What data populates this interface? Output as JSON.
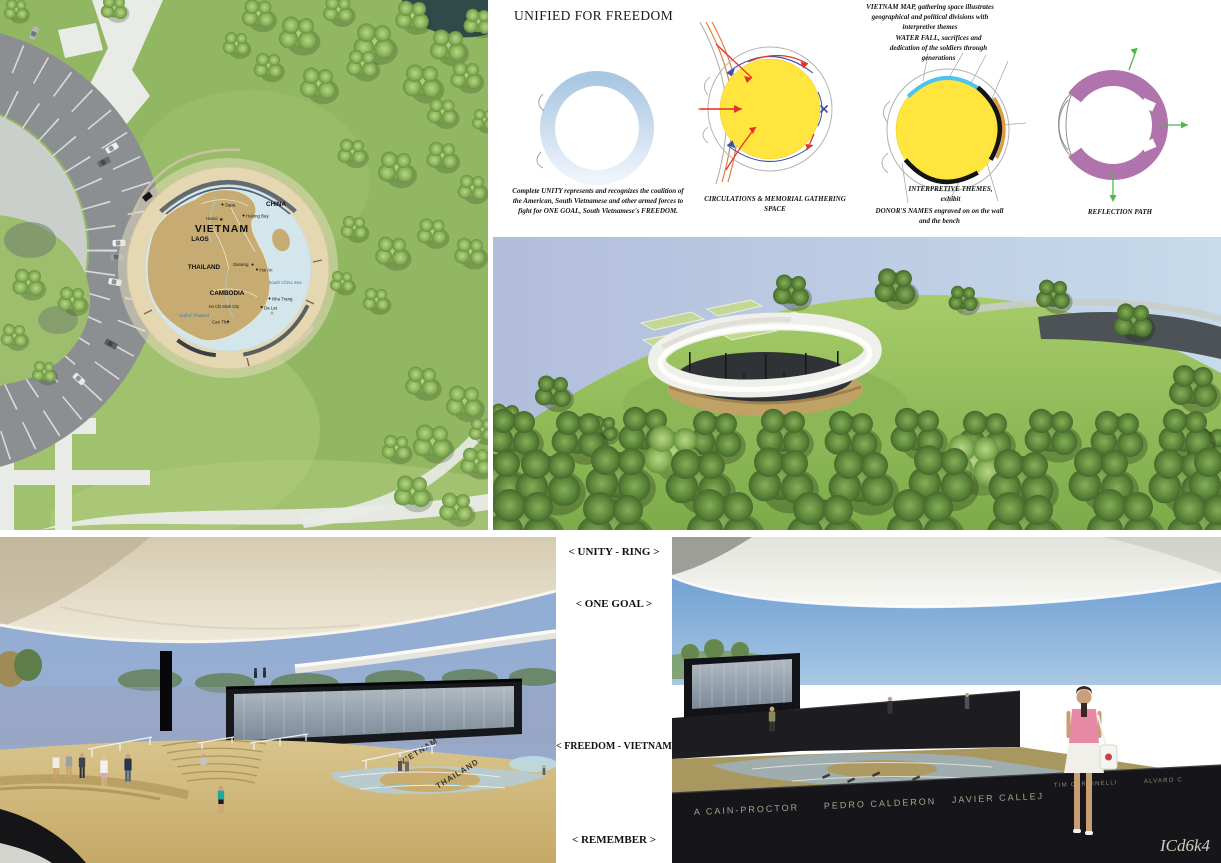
{
  "board": {
    "title": "UNIFIED FOR FREEDOM",
    "watermark": "ICd6k4"
  },
  "site_plan": {
    "labels": {
      "vietnam": "VIETNAM",
      "china": "CHINA",
      "laos": "LAOS",
      "thailand": "THAILAND",
      "cambodia": "CAMBODIA",
      "sapa": "Sapa",
      "hanoi": "Hanoi",
      "halong_bay": "Halong Bay",
      "danang": "Danang",
      "hoi_an": "Hoi An",
      "nha_trang": "Nha Trang",
      "da_lat": "Da Lat",
      "ho_chi_minh_city": "Ho Chi Minh City",
      "can_tho": "Can Tho",
      "south_china_sea": "South China Sea",
      "gulf_of_thailand": "Gulf of Thailand"
    },
    "icons": {
      "hanoi_star": "★"
    }
  },
  "diagrams": {
    "unity": {
      "caption": "Complete UNITY represents and recognizes the coalition of the American, South Vietnamese and other armed forces to fight for ONE GOAL, South Vietnamese's FREEDOM."
    },
    "circulation": {
      "caption": "CIRCULATIONS & MEMORIAL GATHERING SPACE"
    },
    "program": {
      "vietnam_map_note": "VIETNAM MAP, gathering space illustrates geographical and political divisions with interpretive themes",
      "water_fall_note": "WATER FALL, sacrifices and dedication of the soldiers through generations",
      "interpretive_note": "INTERPRETIVE THEMES, exhibit",
      "donors_note": "DONOR'S NAMES engraved on on the wall and the bench"
    },
    "reflection": {
      "caption": "REFLECTION PATH"
    }
  },
  "section_labels": {
    "unity_ring": "< UNITY - RING >",
    "one_goal": "< ONE GOAL >",
    "freedom_vietnam": "< FREEDOM - VIETNAM >",
    "remember": "< REMEMBER >"
  },
  "renders": {
    "bottom_left": {
      "floor_label_1": "VIETNAM",
      "floor_label_2": "THAILAND"
    },
    "bottom_right": {
      "name1": "A CAIN-PROCTOR",
      "name2": "PEDRO CALDERON",
      "name3": "JAVIER CALLEJ",
      "name4": "TIM CARPINELLI",
      "name5": "ALVARO C"
    }
  },
  "colors": {
    "unity_ring_blue": "#b9d2ea",
    "gathering_yellow": "#ffe53e",
    "waterfall_cyan": "#4cc4ee",
    "reflection_purple": "#b173ac",
    "arrow_green": "#4db848",
    "circulation_blue": "#3c50a8",
    "entry_red": "#e23328"
  }
}
